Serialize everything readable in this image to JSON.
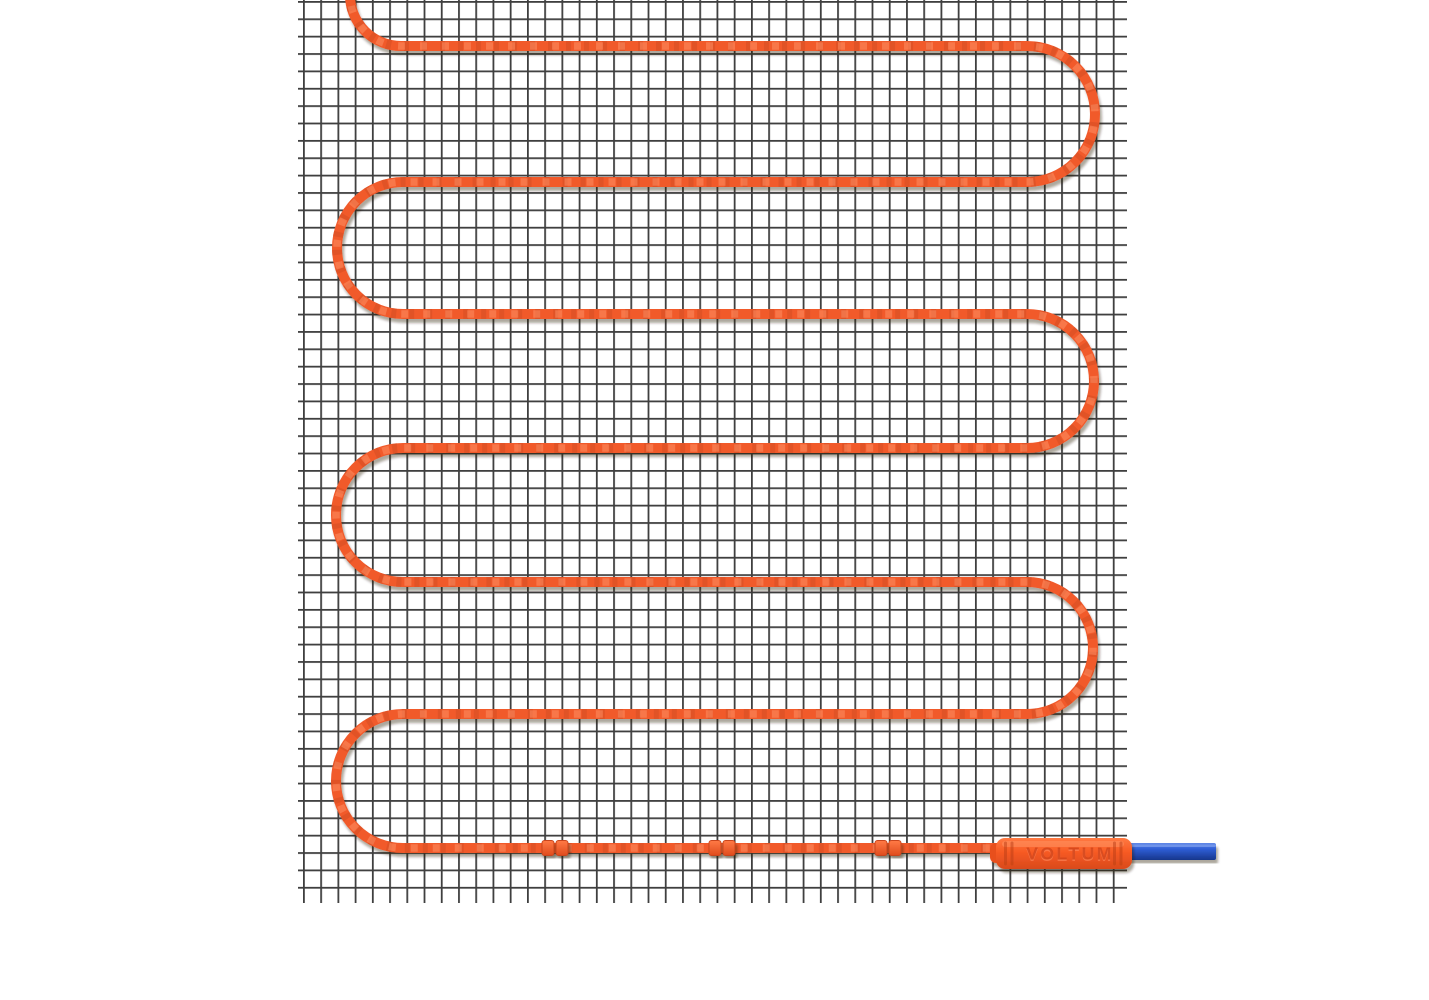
{
  "scene": {
    "description": "Electric underfloor heating mat: orange heating cable laid in a serpentine on a dark wire mesh, with branded connector and blue cold-lead cable",
    "brand_label": "VOLTUM",
    "mat": {
      "cable_runs_visible": 7,
      "cable_clips_visible": 3,
      "mesh_columns_visible": 48,
      "mesh_rows_visible": 52
    },
    "colors": {
      "background": "#ffffff",
      "mesh_line": "#3f3f3f",
      "cable_main": "#f15a2c",
      "cable_dark": "#c9451c",
      "cable_light": "#ff9466",
      "connector_body": "#f75a24",
      "connector_text": "#d0431a",
      "connector_text_highlight": "#ff8a5e",
      "cold_lead_blue": "#2f5ed6",
      "cold_lead_blue_dark": "#17368c",
      "cold_lead_blue_light": "#6189e8"
    }
  }
}
